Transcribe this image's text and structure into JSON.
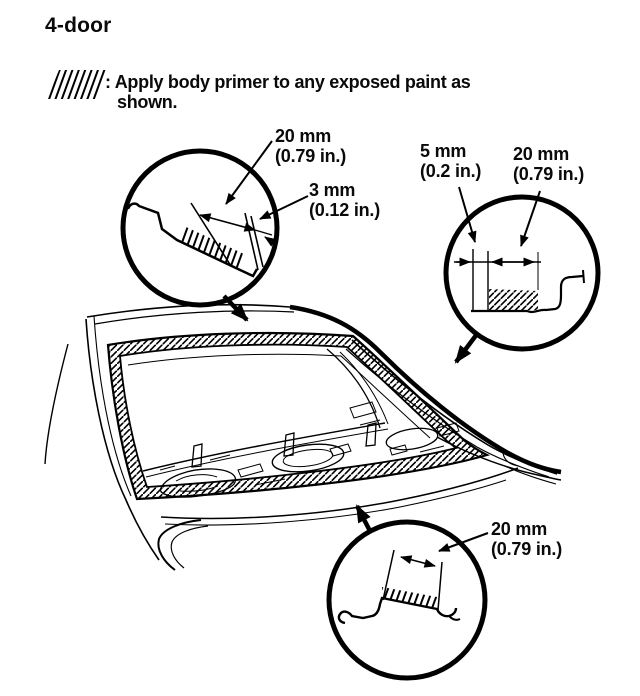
{
  "page_title": "4-door",
  "legend": {
    "symbol": "primer-hatch-swatch",
    "line1": ": Apply body primer to any exposed paint as",
    "line2": "shown."
  },
  "callouts": {
    "c1": {
      "location": "upper-window-flange-detail",
      "d1": {
        "mm": "20 mm",
        "in": "(0.79 in.)"
      },
      "d2": {
        "mm": "3 mm",
        "in": "(0.12 in.)"
      }
    },
    "c2": {
      "location": "side-window-flange-detail",
      "d1": {
        "mm": "5 mm",
        "in": "(0.2 in.)"
      },
      "d2": {
        "mm": "20 mm",
        "in": "(0.79 in.)"
      }
    },
    "c3": {
      "location": "lower-window-flange-detail",
      "d1": {
        "mm": "20 mm",
        "in": "(0.79 in.)"
      }
    }
  },
  "colors": {
    "ink": "#000000",
    "paper": "#ffffff"
  }
}
